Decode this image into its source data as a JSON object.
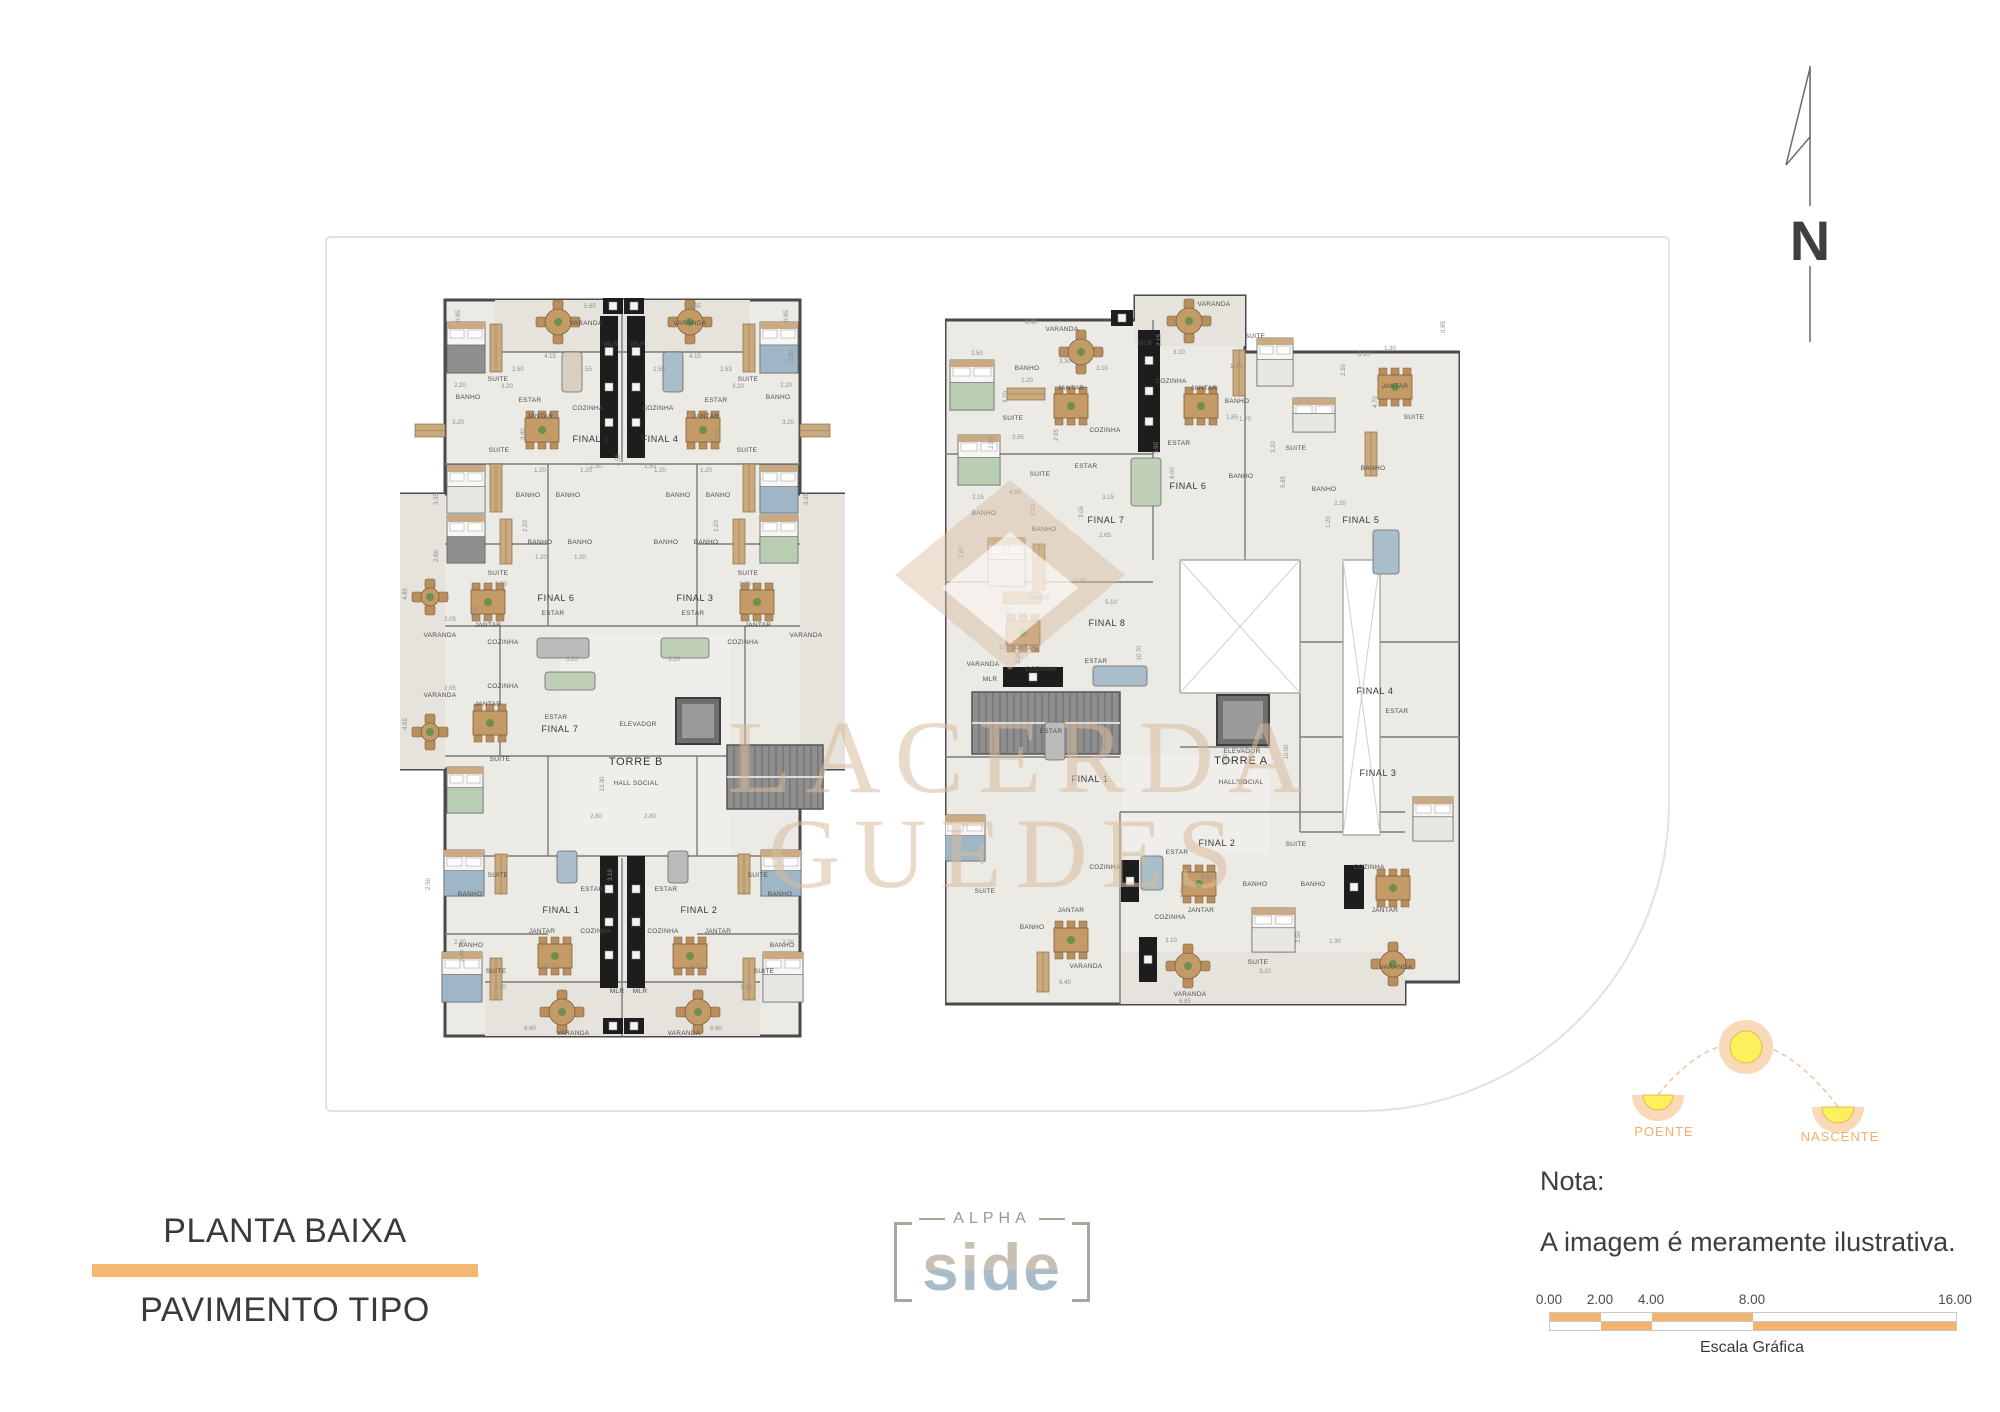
{
  "title_block": {
    "line1": "PLANTA BAIXA",
    "line2": "PAVIMENTO TIPO",
    "accent_color": "#F5B873"
  },
  "logo": {
    "top": "ALPHA",
    "main": "side"
  },
  "note": {
    "heading": "Nota:",
    "body": "A imagem é meramente ilustrativa."
  },
  "scale_bar": {
    "ticks": [
      "0.00",
      "2.00",
      "4.00",
      "8.00",
      "16.00"
    ],
    "caption": "Escala Gráfica",
    "color": "#F2B46E"
  },
  "sun_diagram": {
    "west_label": "POENTE",
    "east_label": "NASCENTE",
    "label_color": "#F5AE6B"
  },
  "compass": {
    "label": "N"
  },
  "watermark": {
    "line1": "LACERDA",
    "line2": "GUEDES",
    "color": "#D8BC9D"
  },
  "tower_b": {
    "core": {
      "elevator": "ELEVADOR",
      "name": "TORRE B",
      "hall": "HALL SOCIAL"
    },
    "units": [
      [
        "FINAL 5",
        191,
        148
      ],
      [
        "FINAL 4",
        260,
        148
      ],
      [
        "FINAL 6",
        156,
        307
      ],
      [
        "FINAL 3",
        295,
        307
      ],
      [
        "FINAL 7",
        160,
        438
      ],
      [
        "FINAL 1",
        161,
        619
      ],
      [
        "FINAL 2",
        299,
        619
      ]
    ],
    "rooms": [
      [
        "VARANDA",
        186,
        31
      ],
      [
        "VARANDA",
        290,
        31
      ],
      [
        "MLR",
        211,
        52
      ],
      [
        "MLR",
        238,
        52
      ],
      [
        "SUITE",
        98,
        87
      ],
      [
        "SUITE",
        348,
        87
      ],
      [
        "BANHO",
        68,
        105
      ],
      [
        "BANHO",
        378,
        105
      ],
      [
        "ESTAR",
        130,
        108
      ],
      [
        "ESTAR",
        316,
        108
      ],
      [
        "COZINHA",
        188,
        116
      ],
      [
        "COZINHA",
        258,
        116
      ],
      [
        "JANTAR",
        140,
        124
      ],
      [
        "JANTAR",
        306,
        124
      ],
      [
        "SUITE",
        99,
        158
      ],
      [
        "SUITE",
        347,
        158
      ],
      [
        "BANHO",
        128,
        203
      ],
      [
        "BANHO",
        168,
        203
      ],
      [
        "BANHO",
        278,
        203
      ],
      [
        "BANHO",
        318,
        203
      ],
      [
        "BANHO",
        140,
        250
      ],
      [
        "BANHO",
        180,
        250
      ],
      [
        "BANHO",
        266,
        250
      ],
      [
        "BANHO",
        306,
        250
      ],
      [
        "SUITE",
        98,
        281
      ],
      [
        "SUITE",
        348,
        281
      ],
      [
        "ESTAR",
        153,
        321
      ],
      [
        "ESTAR",
        293,
        321
      ],
      [
        "JANTAR",
        88,
        333
      ],
      [
        "JANTAR",
        358,
        333
      ],
      [
        "COZINHA",
        103,
        350
      ],
      [
        "COZINHA",
        343,
        350
      ],
      [
        "VARANDA",
        40,
        343
      ],
      [
        "VARANDA",
        406,
        343
      ],
      [
        "COZINHA",
        103,
        394
      ],
      [
        "JANTAR",
        88,
        412
      ],
      [
        "ESTAR",
        156,
        425
      ],
      [
        "VARANDA",
        40,
        403
      ],
      [
        "SUITE",
        100,
        467
      ],
      [
        "ELEVADOR",
        238,
        432
      ],
      [
        "SUITE",
        98,
        583
      ],
      [
        "SUITE",
        358,
        583
      ],
      [
        "ESTAR",
        192,
        597
      ],
      [
        "ESTAR",
        266,
        597
      ],
      [
        "BANHO",
        70,
        602
      ],
      [
        "BANHO",
        380,
        602
      ],
      [
        "JANTAR",
        142,
        639
      ],
      [
        "JANTAR",
        318,
        639
      ],
      [
        "COZINHA",
        196,
        639
      ],
      [
        "COZINHA",
        263,
        639
      ],
      [
        "BANHO",
        71,
        653
      ],
      [
        "BANHO",
        382,
        653
      ],
      [
        "SUITE",
        96,
        679
      ],
      [
        "SUITE",
        364,
        679
      ],
      [
        "MLR",
        217,
        699
      ],
      [
        "MLR",
        240,
        699
      ],
      [
        "VARANDA",
        173,
        741
      ],
      [
        "VARANDA",
        284,
        741
      ]
    ],
    "dims": [
      [
        "5.65",
        190,
        14
      ],
      [
        "5.65",
        295,
        14
      ],
      [
        "0.85",
        60,
        22,
        "v"
      ],
      [
        "0.85",
        388,
        22,
        "v"
      ],
      [
        "4.15",
        150,
        64
      ],
      [
        "4.15",
        295,
        64
      ],
      [
        "2.50",
        118,
        77
      ],
      [
        "2.53",
        326,
        77
      ],
      [
        "1.55",
        186,
        77
      ],
      [
        "1.55",
        259,
        77
      ],
      [
        "2.50",
        52,
        62,
        "v"
      ],
      [
        "2.50",
        393,
        62,
        "v"
      ],
      [
        "3.20",
        107,
        94
      ],
      [
        "3.20",
        338,
        94
      ],
      [
        "2.20",
        60,
        93
      ],
      [
        "2.20",
        386,
        93
      ],
      [
        "3.20",
        58,
        130
      ],
      [
        "3.20",
        388,
        130
      ],
      [
        "3.80",
        125,
        140,
        "v"
      ],
      [
        "3.80",
        320,
        140,
        "v"
      ],
      [
        "4.50",
        220,
        166,
        "v"
      ],
      [
        "1.50",
        196,
        174
      ],
      [
        "1.50",
        250,
        174
      ],
      [
        "1.20",
        140,
        178
      ],
      [
        "1.20",
        186,
        178
      ],
      [
        "1.20",
        260,
        178
      ],
      [
        "1.20",
        306,
        178
      ],
      [
        "3.35",
        38,
        205,
        "v"
      ],
      [
        "3.35",
        408,
        205,
        "v"
      ],
      [
        "2.20",
        127,
        232,
        "v"
      ],
      [
        "2.20",
        318,
        232,
        "v"
      ],
      [
        "3.70",
        101,
        292
      ],
      [
        "3.70",
        345,
        292
      ],
      [
        "2.60",
        38,
        262,
        "v"
      ],
      [
        "1.20",
        141,
        265
      ],
      [
        "1.20",
        180,
        265
      ],
      [
        "4.85",
        7,
        300,
        "v"
      ],
      [
        "2.05",
        50,
        327
      ],
      [
        "3.00",
        77,
        318,
        "v"
      ],
      [
        "5.20",
        172,
        367
      ],
      [
        "5.20",
        274,
        367
      ],
      [
        "4.65",
        7,
        430,
        "v"
      ],
      [
        "2.05",
        50,
        396
      ],
      [
        "13.30",
        204,
        490,
        "v"
      ],
      [
        "2.80",
        196,
        524
      ],
      [
        "2.80",
        250,
        524
      ],
      [
        "3.10",
        212,
        581,
        "v"
      ],
      [
        "3.20",
        100,
        695
      ],
      [
        "3.20",
        346,
        695
      ],
      [
        "4.15",
        150,
        674
      ],
      [
        "4.15",
        296,
        674
      ],
      [
        "2.40",
        64,
        662,
        "v"
      ],
      [
        "6.60",
        130,
        736
      ],
      [
        "6.60",
        316,
        736
      ],
      [
        "2.50",
        30,
        590,
        "v"
      ],
      [
        "2.20",
        60,
        650
      ],
      [
        "2.20",
        388,
        650
      ]
    ]
  },
  "tower_a": {
    "core": {
      "elevator": "ELEVADOR",
      "name": "TORRE A",
      "hall": "HALL SOCIAL"
    },
    "units": [
      [
        "FINAL 7",
        161,
        231
      ],
      [
        "FINAL 6",
        243,
        197
      ],
      [
        "FINAL 5",
        416,
        231
      ],
      [
        "FINAL 8",
        162,
        334
      ],
      [
        "FINAL 4",
        430,
        402
      ],
      [
        "FINAL 3",
        433,
        484
      ],
      [
        "FINAL 1",
        145,
        490
      ],
      [
        "FINAL 2",
        272,
        554
      ]
    ],
    "rooms": [
      [
        "VARANDA",
        117,
        39
      ],
      [
        "VARANDA",
        269,
        14
      ],
      [
        "BANHO",
        82,
        78
      ],
      [
        "SUITE",
        68,
        128
      ],
      [
        "JANTAR",
        126,
        98
      ],
      [
        "COZINHA",
        160,
        140
      ],
      [
        "MLR",
        200,
        53
      ],
      [
        "COZINHA",
        226,
        91
      ],
      [
        "JANTAR",
        259,
        98
      ],
      [
        "SUITE",
        310,
        46
      ],
      [
        "BANHO",
        292,
        111
      ],
      [
        "ESTAR",
        234,
        153
      ],
      [
        "ESTAR",
        141,
        176
      ],
      [
        "SUITE",
        95,
        184
      ],
      [
        "SUITE",
        351,
        158
      ],
      [
        "BANHO",
        296,
        186
      ],
      [
        "BANHO",
        379,
        199
      ],
      [
        "BANHO",
        39,
        223
      ],
      [
        "BANHO",
        99,
        239
      ],
      [
        "SUITE",
        95,
        308
      ],
      [
        "JANTAR",
        79,
        358
      ],
      [
        "VARANDA",
        38,
        374
      ],
      [
        "COZINHA",
        96,
        379
      ],
      [
        "MLR",
        45,
        389
      ],
      [
        "ESTAR",
        151,
        371
      ],
      [
        "ELEVADOR",
        297,
        461
      ],
      [
        "ESTAR",
        106,
        441
      ],
      [
        "SUITE",
        40,
        601
      ],
      [
        "BANHO",
        87,
        637
      ],
      [
        "JANTAR",
        126,
        620
      ],
      [
        "COZINHA",
        160,
        577
      ],
      [
        "VARANDA",
        141,
        676
      ],
      [
        "ESTAR",
        232,
        562
      ],
      [
        "JANTAR",
        256,
        620
      ],
      [
        "COZINHA",
        225,
        627
      ],
      [
        "BANHO",
        310,
        594
      ],
      [
        "BANHO",
        368,
        594
      ],
      [
        "SUITE",
        313,
        672
      ],
      [
        "VARANDA",
        245,
        704
      ],
      [
        "SUITE",
        351,
        554
      ],
      [
        "COZINHA",
        424,
        577
      ],
      [
        "JANTAR",
        440,
        620
      ],
      [
        "VARANDA",
        451,
        677
      ],
      [
        "SUITE",
        469,
        127
      ],
      [
        "ESTAR",
        452,
        421
      ],
      [
        "JANTAR",
        450,
        96
      ],
      [
        "BANHO",
        428,
        178
      ]
    ],
    "dims": [
      [
        "6.40",
        86,
        32
      ],
      [
        "2.50",
        32,
        63
      ],
      [
        "3.30",
        120,
        71
      ],
      [
        "1.20",
        82,
        90
      ],
      [
        "3.85",
        73,
        147
      ],
      [
        "2.95",
        113,
        143,
        "v"
      ],
      [
        "3.10",
        157,
        78
      ],
      [
        "3.10",
        234,
        62
      ],
      [
        "2.15",
        216,
        48,
        "v"
      ],
      [
        "1.70",
        291,
        76
      ],
      [
        "1.85",
        287,
        127
      ],
      [
        "3.20",
        62,
        105,
        "v"
      ],
      [
        "2.50",
        48,
        151,
        "v"
      ],
      [
        "4.50",
        70,
        202
      ],
      [
        "2.15",
        33,
        207
      ],
      [
        "2.20",
        90,
        218,
        "v"
      ],
      [
        "3.05",
        138,
        220,
        "v"
      ],
      [
        "2.65",
        160,
        245
      ],
      [
        "3.15",
        163,
        207
      ],
      [
        "5.90",
        213,
        156,
        "v"
      ],
      [
        "6.00",
        229,
        181,
        "v"
      ],
      [
        "3.10",
        419,
        64
      ],
      [
        "1.30",
        445,
        58
      ],
      [
        "2.50",
        400,
        78,
        "v"
      ],
      [
        "1.70",
        300,
        129
      ],
      [
        "3.20",
        330,
        155,
        "v"
      ],
      [
        "2.20",
        395,
        213
      ],
      [
        "5.85",
        340,
        190,
        "v"
      ],
      [
        "1.20",
        385,
        230,
        "v"
      ],
      [
        "3.60",
        60,
        320
      ],
      [
        "2.60",
        18,
        260,
        "v"
      ],
      [
        "2.05",
        60,
        357
      ],
      [
        "3.00",
        75,
        366,
        "v"
      ],
      [
        "5.10",
        166,
        312
      ],
      [
        "1.20",
        135,
        291
      ],
      [
        "10.70",
        196,
        361,
        "v"
      ],
      [
        "10.00",
        343,
        460,
        "v"
      ],
      [
        "7.75",
        296,
        492
      ],
      [
        "1.50",
        282,
        468,
        "v"
      ],
      [
        "6.85",
        240,
        711
      ],
      [
        "3.10",
        226,
        650
      ],
      [
        "1.65",
        262,
        587
      ],
      [
        "1.70",
        240,
        600,
        "v"
      ],
      [
        "2.50",
        355,
        645,
        "v"
      ],
      [
        "3.10",
        320,
        681
      ],
      [
        "1.30",
        390,
        651
      ],
      [
        "6.40",
        120,
        692
      ],
      [
        "0.85",
        500,
        35,
        "v"
      ],
      [
        "4.70",
        432,
        110,
        "v"
      ]
    ]
  }
}
